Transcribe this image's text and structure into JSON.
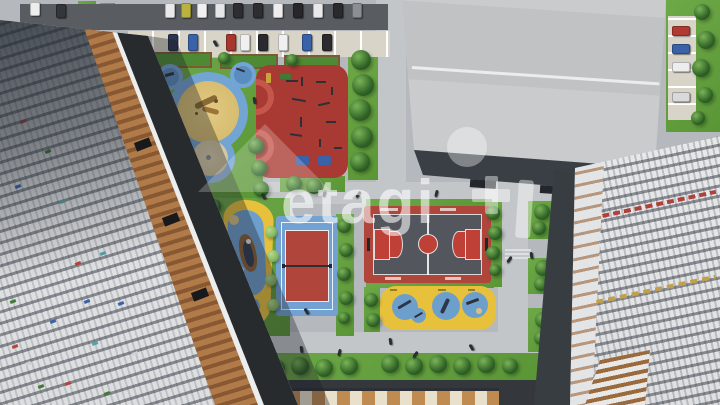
{
  "scene": {
    "description": "Aerial 3D render of a residential courtyard with playgrounds, sports courts, parking and apartment towers",
    "watermark": {
      "text": "etagi",
      "color": "#ffffff",
      "opacity": 0.58
    }
  },
  "palette": {
    "lawn": "#64a03f",
    "path": "#b5b9bd",
    "promenade": "#c3c6c9",
    "asphalt_road": "#383d42",
    "parking_road": "#595d61",
    "parking_stalls": "#d8d5c8",
    "playground_blue": "#72a4d4",
    "playground_blue_dark": "#5a8cc0",
    "fitness_red": "#a93a33",
    "playground_yellow": "#e7c13c",
    "sand": "#dcc27e",
    "sand_light": "#d9cda9",
    "court_red": "#b0453c",
    "court_floor": "#53575d",
    "roof_gray": "#c6c8ca",
    "facade_white": "#e6e7e8",
    "balcony_orange": "#a9743f",
    "tree_dark_green": "#2f6326",
    "tree_light_green": "#86b85c",
    "bench_blue": "#3a62a8",
    "bench_green": "#3f7a37"
  },
  "parking": {
    "top_row_car_colors": [
      "#e9e9e9",
      "#b9b23f",
      "#f0f0f0",
      "#e6e6e6",
      "#2e2e32",
      "#2e2e32",
      "#ededed",
      "#27272b",
      "#e9e9e9",
      "#2a2a2e",
      "#8b8f93"
    ],
    "stall_row_car_colors": [
      "#2a3550",
      "#3a62a8",
      "#a8362e",
      "#f0f0f0",
      "#2b2b2f",
      "#f0f0f0",
      "#3a62a8",
      "#2b2b2f"
    ],
    "right_column_car_colors": [
      "#b03a31",
      "#3a62a8",
      "#ededed",
      "#d9d9d9"
    ]
  },
  "areas": {
    "labels": [
      "bear playground",
      "fitness area",
      "ship playground",
      "volleyball court",
      "basketball court",
      "toddler playground",
      "parking lot",
      "school roof",
      "apartment towers"
    ]
  }
}
